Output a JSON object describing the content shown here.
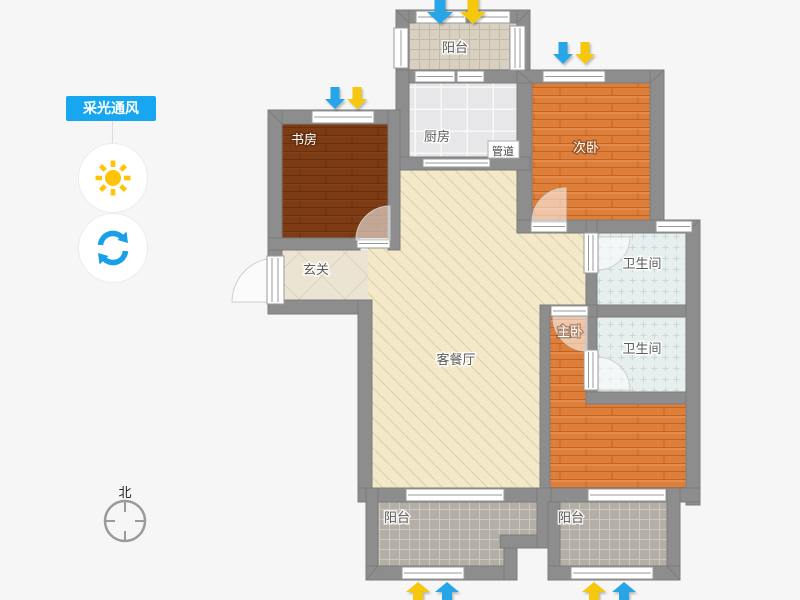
{
  "sidebar": {
    "title": "采光通风",
    "tools": [
      {
        "name": "sunlight",
        "icon": "sun-icon"
      },
      {
        "name": "refresh",
        "icon": "refresh-icon"
      }
    ]
  },
  "compass": {
    "north_label": "北"
  },
  "plan": {
    "labels": {
      "balcony_top": "阳台",
      "kitchen": "厨房",
      "duct": "管道",
      "study": "书房",
      "bedroom_second": "次卧",
      "bathroom_top": "卫生间",
      "foyer": "玄关",
      "living_dining": "客餐厅",
      "master_bedroom": "主卧",
      "bathroom_bottom": "卫生间",
      "balcony_bottom_left": "阳台",
      "balcony_bottom_right": "阳台"
    },
    "colors": {
      "accent_blue": "#16a7f0",
      "sun_yellow": "#ffc408",
      "refresh_blue": "#18a0e9",
      "arrow_blue": "#27a5e8",
      "arrow_yellow": "#f5c70a",
      "wall_gray": "#8d8d8d",
      "living_floor": "#f3e9c8",
      "wood_dark": "#7d3b14",
      "wood_orange": "#de7e3b",
      "bath_tile": "#e6eeee"
    }
  }
}
